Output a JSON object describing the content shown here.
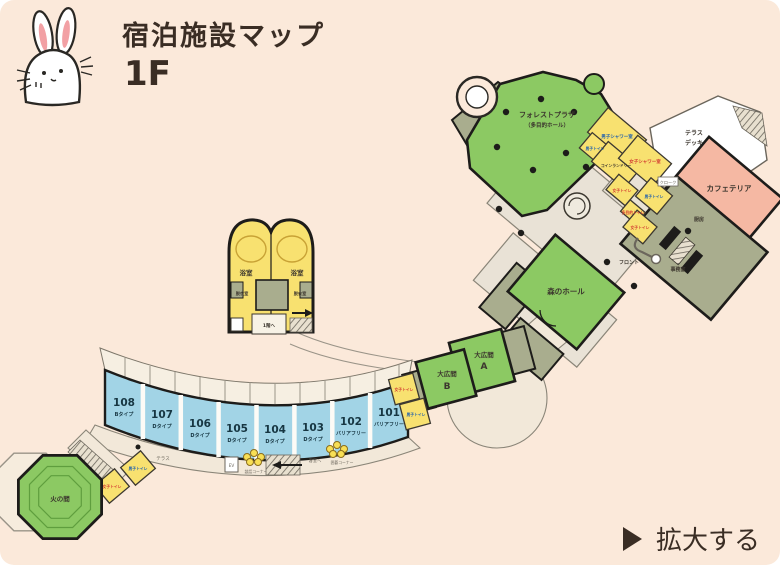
{
  "header": {
    "title": "宿泊施設マップ",
    "floor": "1F"
  },
  "footer": {
    "enlarge": "拡大する"
  },
  "facilities": {
    "forest_plaza_1": "フォレストプラザ",
    "forest_plaza_2": "（多目的ホール）",
    "terrace_deck_1": "テラス",
    "terrace_deck_2": "デッキ",
    "cafeteria": "カフェテリア",
    "kitchen": "厨房",
    "office": "事務室",
    "front": "フロント",
    "cloak": "クローク",
    "mens_shower": "男子シャワー室",
    "womens_shower": "女子シャワー室",
    "coin_laundry": "コインランドリー",
    "mens_toilet": "男子トイレ",
    "womens_toilet": "女子トイレ",
    "multi_toilet": "多目的トイレ",
    "forest_hall": "森のホール",
    "hall_label": "大広間",
    "hall_a": "A",
    "hall_b": "B",
    "bath": "浴室",
    "dressing": "脱衣室",
    "to_1f": "1階へ",
    "hi_no_ma": "火の間",
    "terrace": "テラス",
    "talk_corner": "談話コーナー",
    "go_corner": "囲碁コーナー",
    "to_guestroom": "客室へ",
    "ev": "EV"
  },
  "rooms": [
    {
      "number": "108",
      "type": "Bタイプ"
    },
    {
      "number": "107",
      "type": "Dタイプ"
    },
    {
      "number": "106",
      "type": "Dタイプ"
    },
    {
      "number": "105",
      "type": "Dタイプ"
    },
    {
      "number": "104",
      "type": "Dタイプ"
    },
    {
      "number": "103",
      "type": "Dタイプ"
    },
    {
      "number": "102",
      "type": "バリアフリー"
    },
    {
      "number": "101",
      "type": "バリアフリー"
    }
  ],
  "colors": {
    "background": "#fbe9da",
    "room_green": "#8cc963",
    "service_olive": "#a9ad8e",
    "facility_yellow": "#f8e170",
    "guestroom_blue": "#a2d4e6",
    "cafeteria_salmon": "#f5b8a3",
    "wall": "#1d1c1a",
    "heading_text": "#3a2d24",
    "mens_text": "#1e5fae",
    "womens_text": "#d23a32"
  }
}
